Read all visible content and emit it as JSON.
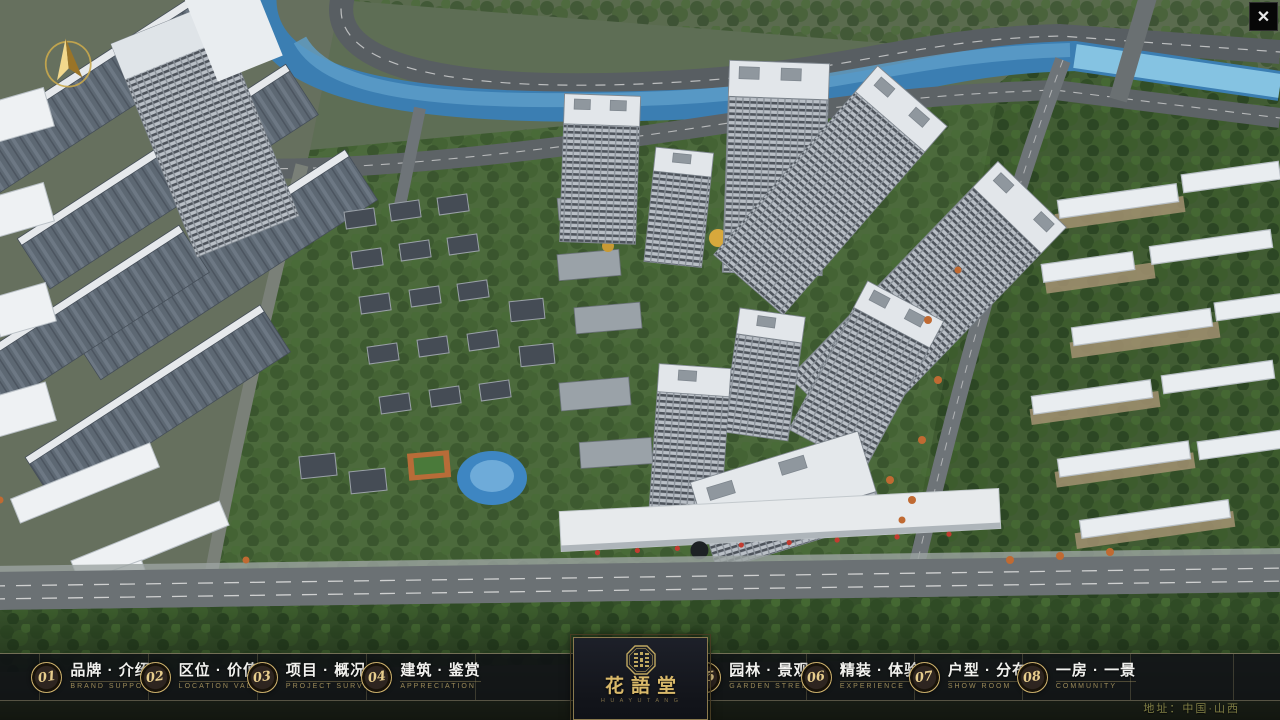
{
  "topbar": {
    "close": "✕"
  },
  "nav": {
    "items": [
      {
        "num": "01",
        "zh": "品牌 · 介绍",
        "en": "BRAND SUPPORT"
      },
      {
        "num": "02",
        "zh": "区位 · 价值",
        "en": "LOCATION VALUE"
      },
      {
        "num": "03",
        "zh": "项目 · 概况",
        "en": "PROJECT SURVEY"
      },
      {
        "num": "04",
        "zh": "建筑 · 鉴赏",
        "en": "APPRECIATION"
      },
      {
        "num": "05",
        "zh": "园林 · 景观",
        "en": "GARDEN STREET"
      },
      {
        "num": "06",
        "zh": "精装 · 体验",
        "en": "EXPERIENCE"
      },
      {
        "num": "07",
        "zh": "户型 · 分布",
        "en": "SHOW ROOM"
      },
      {
        "num": "08",
        "zh": "一房 · 一景",
        "en": "COMMUNITY"
      }
    ]
  },
  "logo": {
    "title": "花語堂",
    "subtext": "H U A Y U T A N G"
  },
  "footer": {
    "address": "地址：中国·山西"
  },
  "colors": {
    "gold": "#c8ad6a",
    "bar_bg": "#0f1115",
    "river": "#3b7eb2"
  }
}
